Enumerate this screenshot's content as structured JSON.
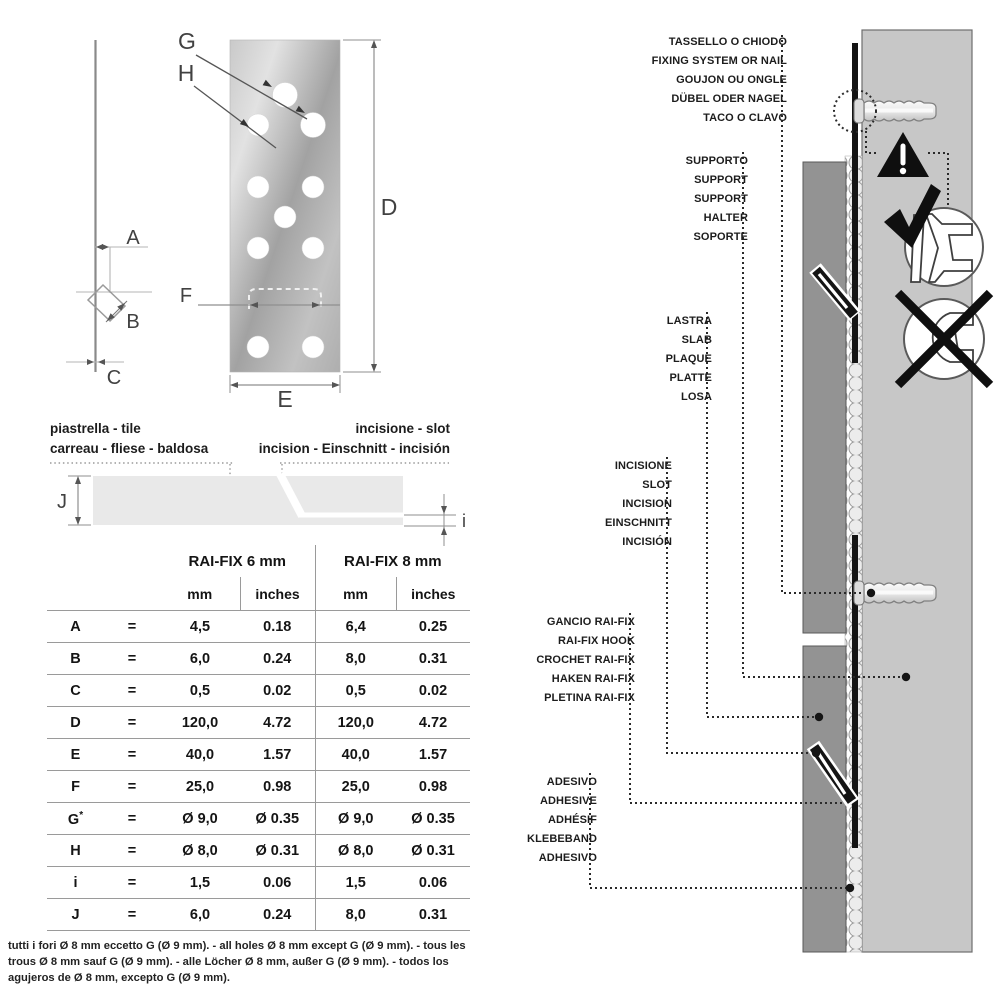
{
  "side_view": {
    "dim_a": "A",
    "dim_b": "B",
    "dim_c": "C"
  },
  "plate": {
    "dim_g": "G",
    "dim_h": "H",
    "dim_d": "D",
    "dim_e": "E",
    "dim_f": "F"
  },
  "tile_section": {
    "left_line1": "piastrella - tile",
    "left_line2": "carreau - fliese - baldosa",
    "right_line1": "incisione - slot",
    "right_line2": "incision - Einschnitt - incisión",
    "dim_j": "J",
    "dim_i": "i"
  },
  "table": {
    "group1": "RAI-FIX 6 mm",
    "group2": "RAI-FIX 8 mm",
    "sub_mm": "mm",
    "sub_inches": "inches",
    "eq": "=",
    "rows": [
      {
        "key": "A",
        "mm6": "4,5",
        "in6": "0.18",
        "mm8": "6,4",
        "in8": "0.25"
      },
      {
        "key": "B",
        "mm6": "6,0",
        "in6": "0.24",
        "mm8": "8,0",
        "in8": "0.31"
      },
      {
        "key": "C",
        "mm6": "0,5",
        "in6": "0.02",
        "mm8": "0,5",
        "in8": "0.02"
      },
      {
        "key": "D",
        "mm6": "120,0",
        "in6": "4.72",
        "mm8": "120,0",
        "in8": "4.72"
      },
      {
        "key": "E",
        "mm6": "40,0",
        "in6": "1.57",
        "mm8": "40,0",
        "in8": "1.57"
      },
      {
        "key": "F",
        "mm6": "25,0",
        "in6": "0.98",
        "mm8": "25,0",
        "in8": "0.98"
      },
      {
        "key": "G",
        "sup": "*",
        "mm6": "Ø 9,0",
        "in6": "Ø 0.35",
        "mm8": "Ø 9,0",
        "in8": "Ø 0.35"
      },
      {
        "key": "H",
        "mm6": "Ø 8,0",
        "in6": "Ø 0.31",
        "mm8": "Ø 8,0",
        "in8": "Ø 0.31"
      },
      {
        "key": "i",
        "mm6": "1,5",
        "in6": "0.06",
        "mm8": "1,5",
        "in8": "0.06"
      },
      {
        "key": "J",
        "mm6": "6,0",
        "in6": "0.24",
        "mm8": "8,0",
        "in8": "0.31"
      }
    ],
    "footnote": "tutti i fori Ø 8 mm eccetto G (Ø 9 mm). - all holes Ø 8 mm except G (Ø 9 mm). - tous les trous Ø 8 mm sauf G (Ø 9 mm). - alle Löcher Ø 8 mm, außer G (Ø 9 mm). - todos los agujeros de Ø 8 mm, excepto G (Ø 9 mm)."
  },
  "installation": {
    "callouts": [
      {
        "id": "fixing",
        "lines": [
          "TASSELLO O CHIODO",
          "FIXING SYSTEM OR NAIL",
          "GOUJON OU ONGLE",
          "DÜBEL ODER NAGEL",
          "TACO O CLAVO"
        ]
      },
      {
        "id": "support",
        "lines": [
          "SUPPORTO",
          "SUPPORT",
          "SUPPORT",
          "HALTER",
          "SOPORTE"
        ]
      },
      {
        "id": "slab",
        "lines": [
          "LASTRA",
          "SLAB",
          "PLAQUE",
          "PLATTE",
          "LOSA"
        ]
      },
      {
        "id": "slot",
        "lines": [
          "INCISIONE",
          "SLOT",
          "INCISION",
          "EINSCHNITT",
          "INCISIÓN"
        ]
      },
      {
        "id": "hook",
        "lines": [
          "GANCIO RAI-FIX",
          "RAI-FIX HOOK",
          "CROCHET RAI-FIX",
          "HAKEN RAI-FIX",
          "PLETINA RAI-FIX"
        ]
      },
      {
        "id": "adhesive",
        "lines": [
          "ADESIVO",
          "ADHESIVE",
          "ADHÉSIF",
          "KLEBEBAND",
          "ADHESIVO"
        ]
      }
    ],
    "warning_mark": "!"
  },
  "colors": {
    "wall": "#c7c7c7",
    "slab": "#939393",
    "tile": "#e9e9e9",
    "ink": "#141414",
    "dim_line": "#a8a8a8"
  }
}
